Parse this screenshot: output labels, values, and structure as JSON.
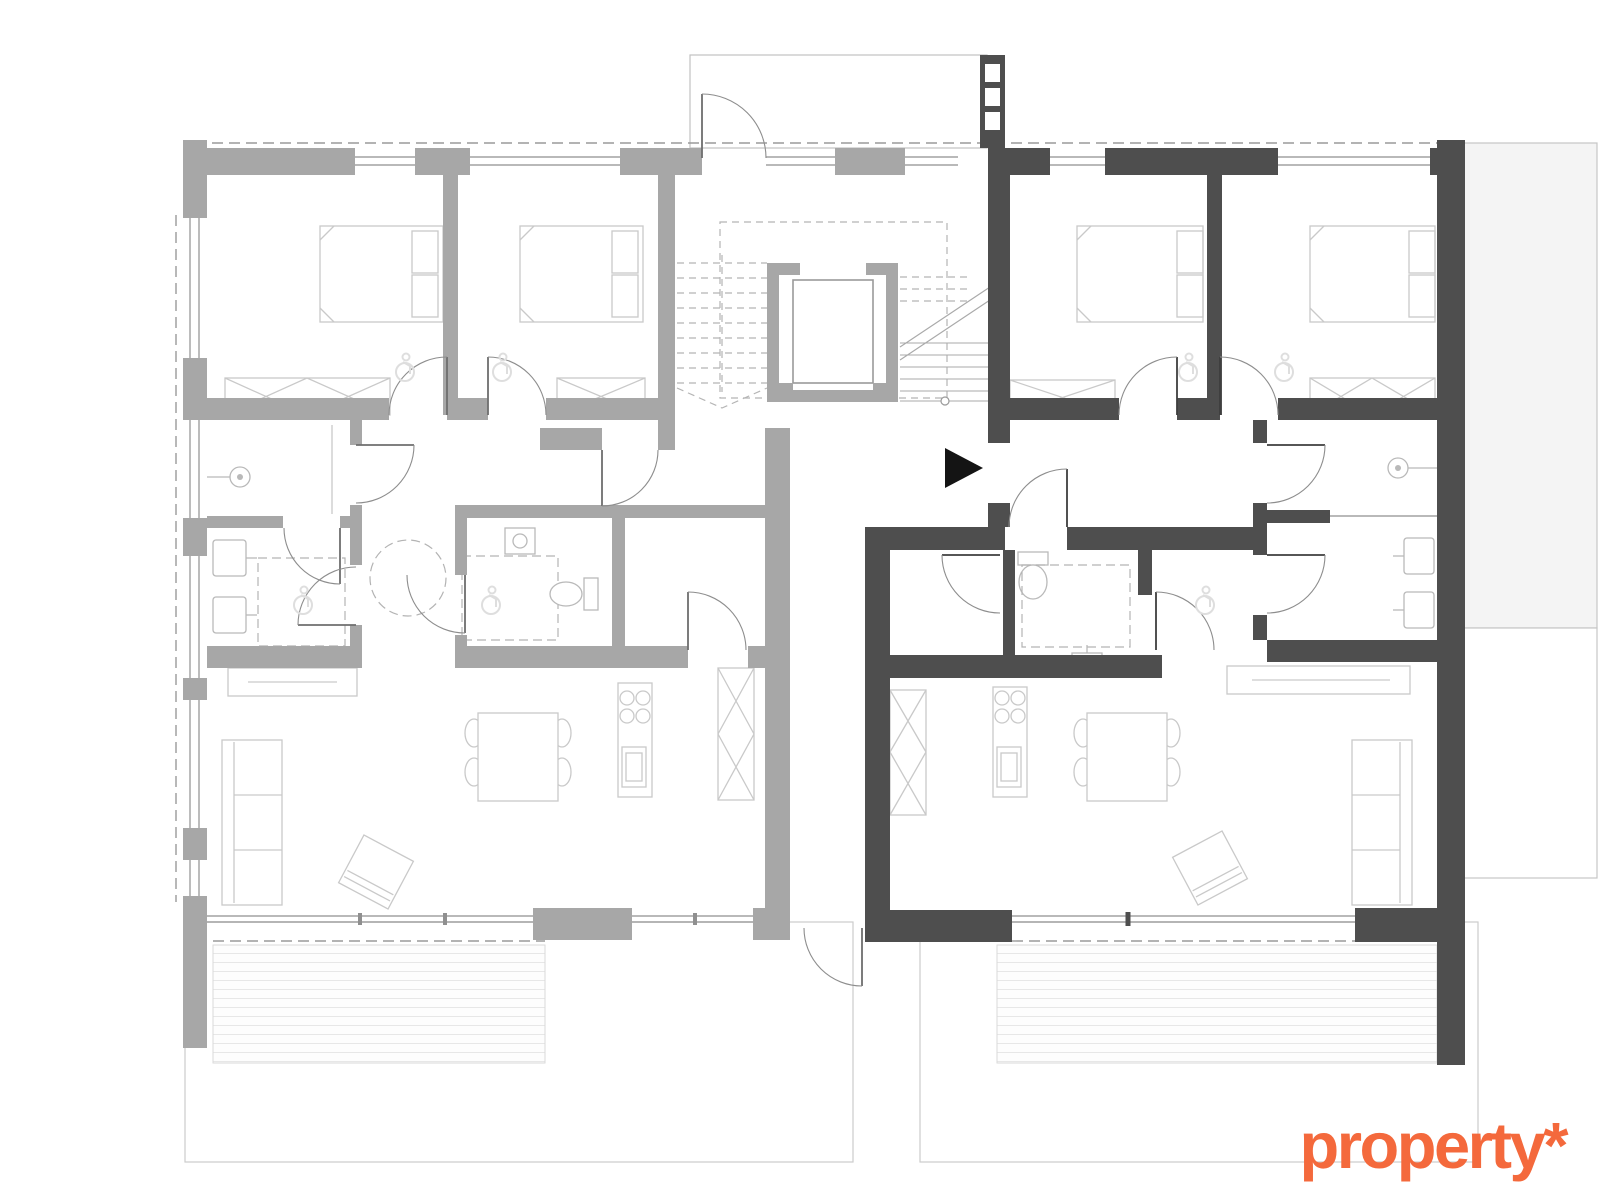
{
  "logo": {
    "text": "property*"
  },
  "palette": {
    "wall-left": "#a7a7a7",
    "wall-right": "#4e4e4e",
    "fur": "#c9c9c9",
    "fixture": "#b9b9b9",
    "thin": "#8f8f8f",
    "dash": "#b3b3b3",
    "deck-stripe": "#e7e7e7",
    "deck-border": "#d9d9d9",
    "garden": "#cccccc",
    "neighbor-fill": "#f4f4f4",
    "neighbor-border": "#c6c6c6",
    "canopy": "#c2c2c2",
    "door": "#6e6e6e",
    "door-dark": "#3e3e3e",
    "arc": "#8d8d8d",
    "arrow": "#141414",
    "access": "#dedede",
    "logo": "#f4693c"
  },
  "plan": {
    "type": "floor-plan",
    "highlighted_unit": "right-apartment",
    "units": [
      {
        "id": "left-apartment",
        "style": "inactive-light",
        "rooms": [
          "bedroom-1",
          "bedroom-2",
          "shower-room",
          "bathroom",
          "inner-bathroom",
          "storage",
          "hall",
          "living-dining-kitchen",
          "terrace"
        ]
      },
      {
        "id": "right-apartment",
        "style": "active-dark",
        "rooms": [
          "bedroom-1",
          "bedroom-2",
          "shower-room",
          "bathroom",
          "wc",
          "storage",
          "hall",
          "living-dining-kitchen",
          "terrace"
        ]
      }
    ],
    "shared": [
      "entrance-porch",
      "mailboxes",
      "stair-core",
      "elevator",
      "rear-passage",
      "garden-left",
      "garden-right",
      "neighbor-building"
    ],
    "symbols": [
      "entrance-arrow-icon",
      "shower-head-icon",
      "accessibility-icon",
      "stove-icon",
      "sink-icon",
      "toilet-icon",
      "bed-icon",
      "sofa-icon",
      "dining-table-icon",
      "wardrobe-icon"
    ]
  }
}
